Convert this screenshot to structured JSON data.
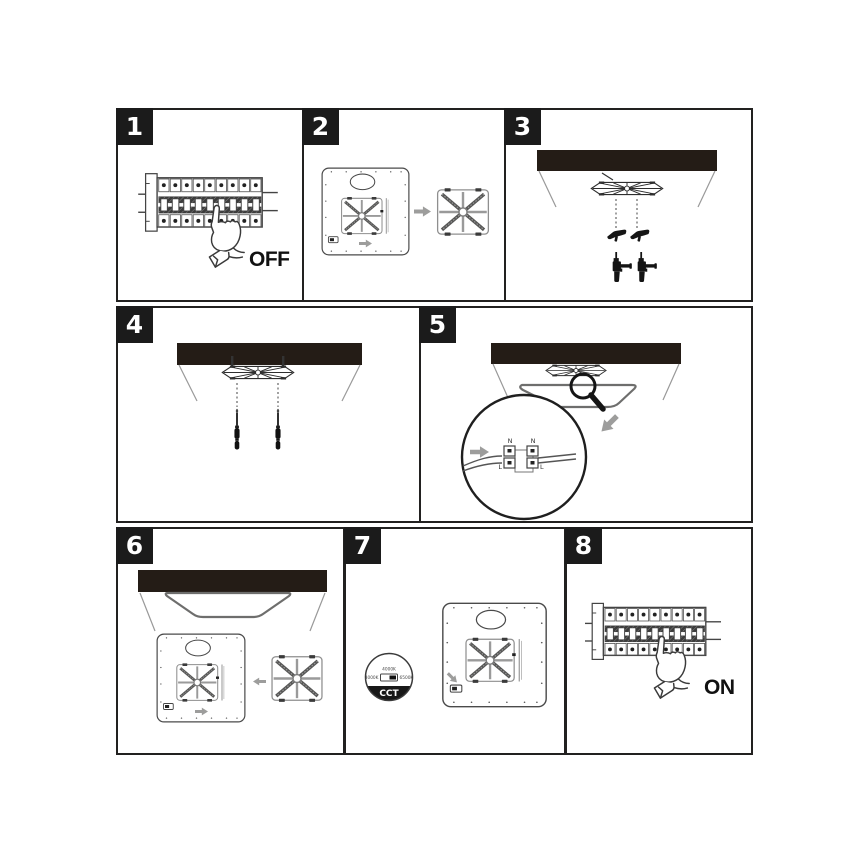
{
  "steps": [
    {
      "number": "1",
      "caption": "OFF",
      "illustration": "circuit-breaker-finger-switch-off"
    },
    {
      "number": "2",
      "illustration": "detach-mounting-bracket-from-panel-back"
    },
    {
      "number": "3",
      "illustration": "ceiling-drill-holes-insert-wall-anchors"
    },
    {
      "number": "4",
      "illustration": "screw-mounting-bracket-to-ceiling"
    },
    {
      "number": "5",
      "illustration": "connect-mains-wires-to-terminal-block",
      "terminal_labels": {
        "top_left": "N",
        "top_right": "N",
        "bottom_left": "L",
        "bottom_right": "L"
      }
    },
    {
      "number": "6",
      "illustration": "clip-panel-back-onto-bracket"
    },
    {
      "number": "7",
      "illustration": "select-color-temperature-switch",
      "cct": {
        "option_top": "4000K",
        "option_left": "3000K",
        "option_right": "6500K",
        "label": "CCT"
      }
    },
    {
      "number": "8",
      "caption": "ON",
      "illustration": "circuit-breaker-finger-switch-on"
    }
  ],
  "colors": {
    "line": "#3c3c3b",
    "ceiling_fill": "#241c16",
    "arrow_gray": "#9d9d9c",
    "silhouette": "#151515",
    "badge_bg": "#1b1b1b",
    "badge_text": "#ffffff"
  }
}
